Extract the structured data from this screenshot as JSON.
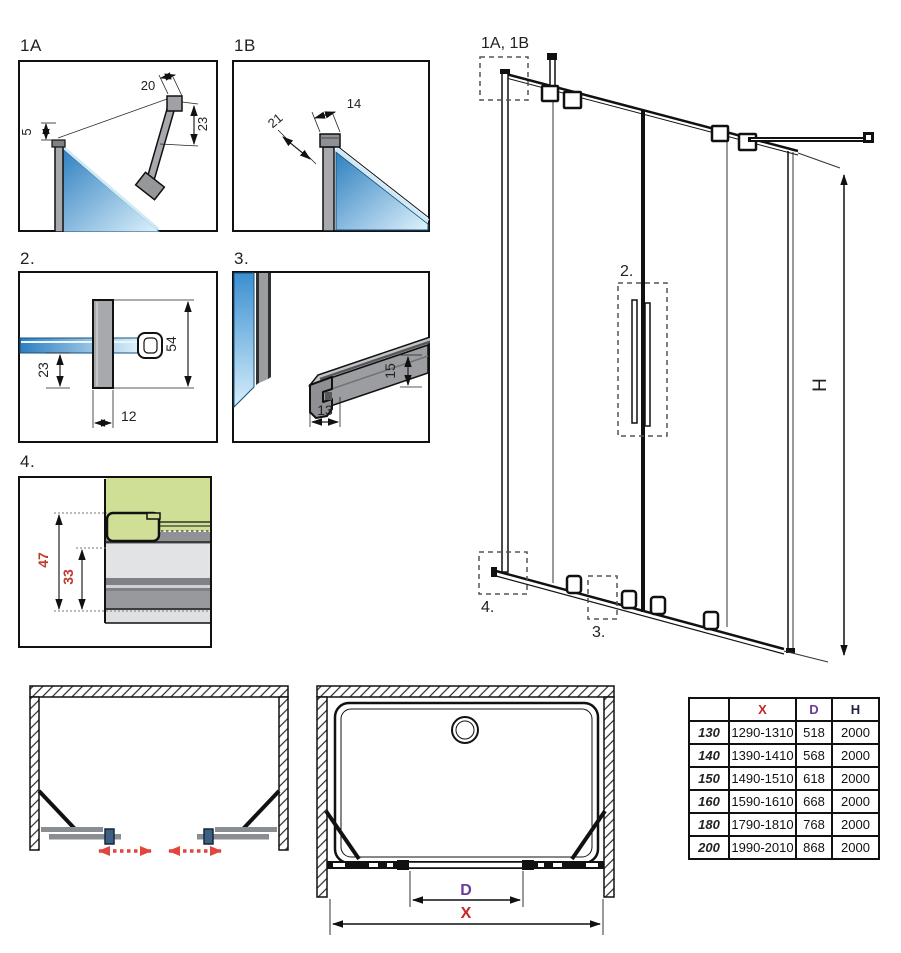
{
  "details": {
    "d1a": {
      "label": "1A",
      "dim_top_width": "20",
      "dim_side_height": "23",
      "dim_gap": "5"
    },
    "d1b": {
      "label": "1B",
      "dim_top_width": "14",
      "dim_depth": "21"
    },
    "d2": {
      "label": "2.",
      "dim_total_height": "54",
      "dim_lower_height": "23",
      "dim_width": "12"
    },
    "d3": {
      "label": "3.",
      "dim_profile_height": "15",
      "dim_profile_width": "13"
    },
    "d4": {
      "label": "4.",
      "dim_outer_height": "47",
      "dim_inner_height": "33"
    }
  },
  "elevation": {
    "callout_top_profiles": "1A, 1B",
    "callout_handle": "2.",
    "callout_bottom_rail": "3.",
    "callout_bottom_corner": "4.",
    "dim_height_label": "H"
  },
  "plans": {
    "dim_door_width_label": "D",
    "dim_total_width_label": "X"
  },
  "size_table": {
    "headers": {
      "size": "",
      "x": "X",
      "d": "D",
      "h": "H"
    },
    "rows": [
      {
        "size": "130",
        "x": "1290-1310",
        "d": "518",
        "h": "2000"
      },
      {
        "size": "140",
        "x": "1390-1410",
        "d": "568",
        "h": "2000"
      },
      {
        "size": "150",
        "x": "1490-1510",
        "d": "618",
        "h": "2000"
      },
      {
        "size": "160",
        "x": "1590-1610",
        "d": "668",
        "h": "2000"
      },
      {
        "size": "180",
        "x": "1790-1810",
        "d": "768",
        "h": "2000"
      },
      {
        "size": "200",
        "x": "1990-2010",
        "d": "868",
        "h": "2000"
      }
    ]
  },
  "colors": {
    "glass_blue": "#2e7fc0",
    "glass_blue_light": "#dff2fb",
    "profile_gray": "#a7a9ad",
    "seal_green": "#cfe096",
    "dim_red_text": "#c0392b",
    "arrow_red": "#e2453c",
    "handle_square_blue": "#3d5f80",
    "table_x_red": "#c2272d",
    "table_d_purple": "#6a3b9c",
    "table_h_navy": "#1f2044"
  }
}
